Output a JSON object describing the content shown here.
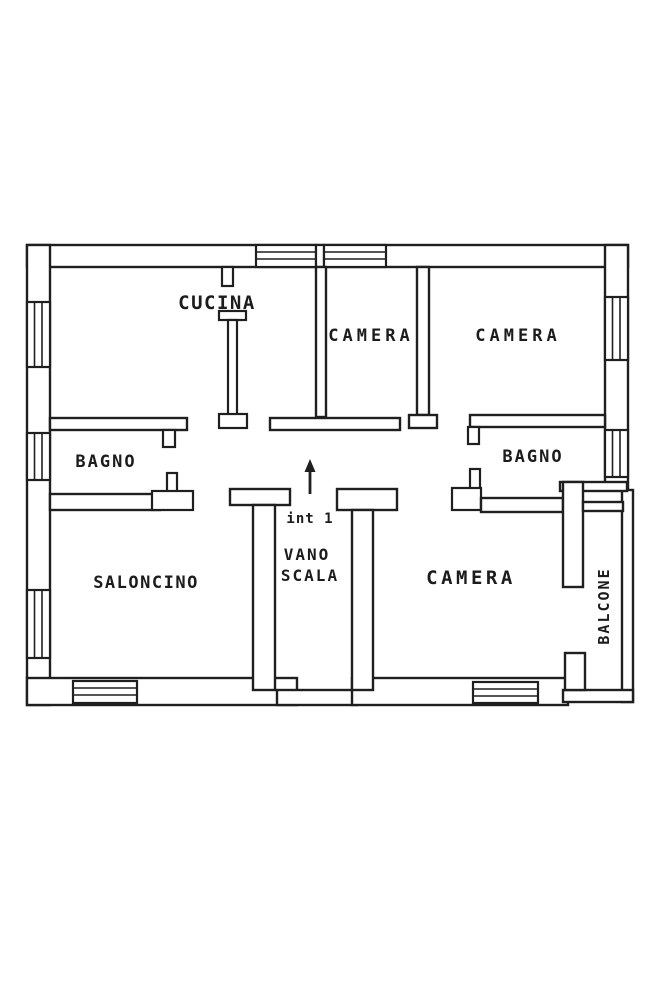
{
  "floor_plan": {
    "paper_color": "#ffffff",
    "ink_color": "#1f1f1f",
    "rooms": {
      "cucina": {
        "label": "CUCINA"
      },
      "camera_top_left": {
        "label": "CAMERA"
      },
      "camera_top_right": {
        "label": "CAMERA"
      },
      "bagno_left": {
        "label": "BAGNO"
      },
      "bagno_right": {
        "label": "BAGNO"
      },
      "saloncino": {
        "label": "SALONCINO"
      },
      "camera_bottom": {
        "label": "CAMERA"
      },
      "vano_scala": {
        "line1": "VANO",
        "line2": "SCALA"
      },
      "balcone": {
        "label": "BALCONE"
      }
    },
    "entrance": {
      "unit_label": "int 1"
    }
  }
}
